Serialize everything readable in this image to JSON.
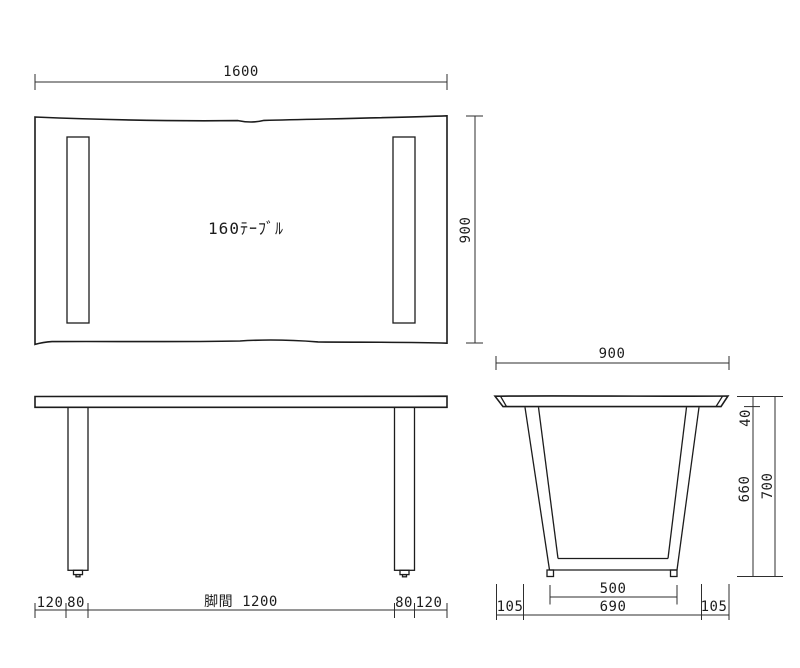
{
  "colors": {
    "line": "#1c1c1c",
    "dimension_line": "#2e2e2e",
    "text": "#1c1c1c",
    "background": "#ffffff"
  },
  "top_view": {
    "label": "160ﾃｰﾌﾞﾙ",
    "width_dim": "1600",
    "depth_dim": "900"
  },
  "front_view": {
    "left_overhang_dim": "120",
    "left_leg_width_dim": "80",
    "leg_span_dim": "脚間 1200",
    "right_leg_width_dim": "80",
    "right_overhang_dim": "120"
  },
  "side_view": {
    "top_width_dim": "900",
    "top_thickness_dim": "40",
    "leg_height_dim": "660",
    "total_height_dim": "700",
    "base_inner_width_dim": "500",
    "base_outer_width_dim": "690",
    "left_offset_dim": "105",
    "right_offset_dim": "105"
  }
}
